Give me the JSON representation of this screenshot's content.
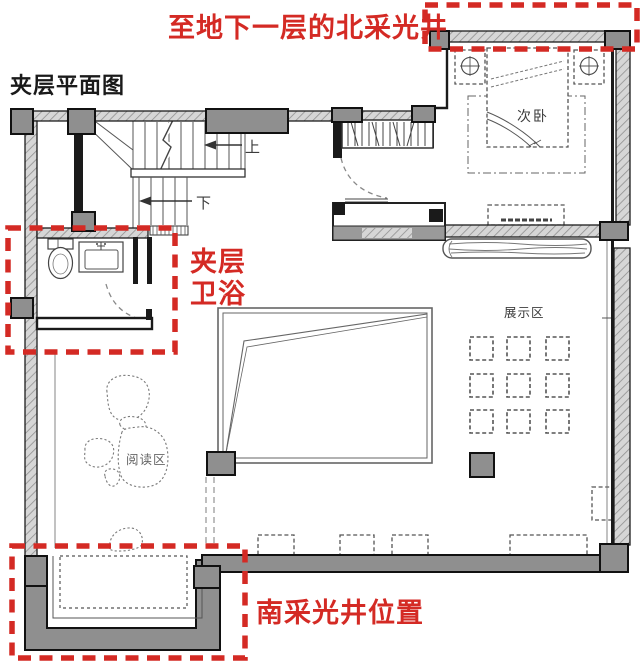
{
  "title": "夹层平面图",
  "annotations": {
    "north_lightwell": "至地下一层的北采光井",
    "bath_line1": "夹层",
    "bath_line2": "卫浴",
    "south_lightwell": "南采光井位置"
  },
  "rooms": {
    "secondary_bedroom": "次卧",
    "display_area": "展示区",
    "reading_area": "阅读区"
  },
  "stairs": {
    "up": "上",
    "down": "下"
  },
  "colors": {
    "annotation_red": "#d42a24",
    "title_black": "#1a1a1a",
    "label_dark": "#3c3c3c",
    "label_gray": "#666666",
    "wall_gray": "#8f8f8f",
    "column_gray": "#878787",
    "hatch_base": "#d6d6d6",
    "hatch_line": "#909090",
    "line_black": "#141414",
    "furniture_line": "#555555",
    "background": "#ffffff"
  }
}
